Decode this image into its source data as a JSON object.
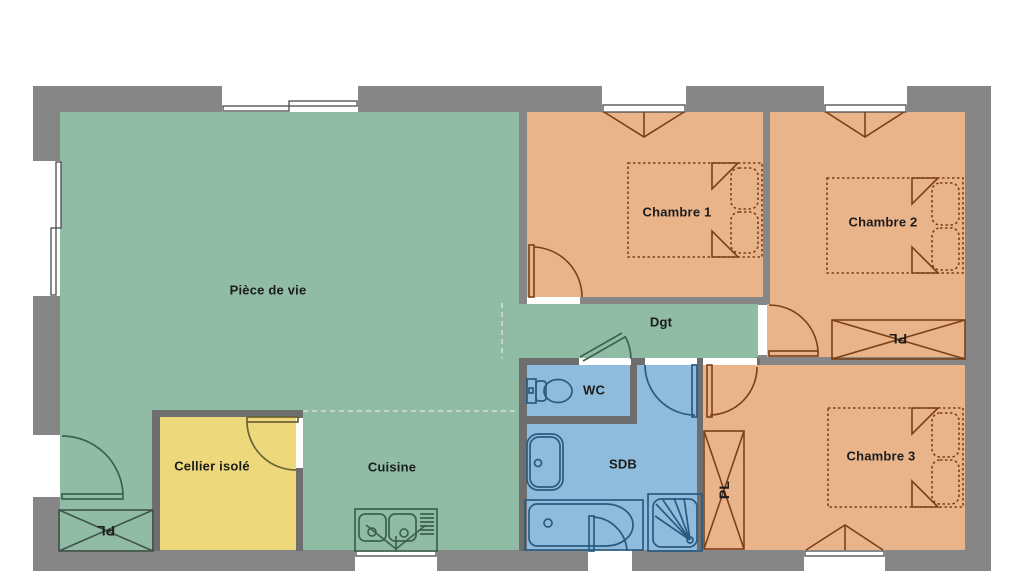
{
  "title": "Plan de maison",
  "rooms": {
    "living": "Pièce de vie",
    "kitchen": "Cuisine",
    "cellar": "Cellier isolé",
    "hallway": "Dgt",
    "wc": "WC",
    "bathroom": "SDB",
    "bedroom1": "Chambre 1",
    "bedroom2": "Chambre 2",
    "bedroom3": "Chambre 3",
    "closet": "PL"
  },
  "colors": {
    "wall": "#868686",
    "wall_dark": "#6e6e6e",
    "living_green": "#90bca5",
    "bedroom_orange": "#eab48b",
    "bathroom_blue": "#8fbcdc",
    "cellar_yellow": "#edd97b",
    "label": "#1c1c1c",
    "line_bed": "#7c4017",
    "line_bath": "#2b5a80",
    "line_green": "#3c624f",
    "line_cellar": "#6a6335",
    "line_closet": "#41534a",
    "line_window": "#4a4a4a",
    "line_dash": "#dcdcdc"
  }
}
